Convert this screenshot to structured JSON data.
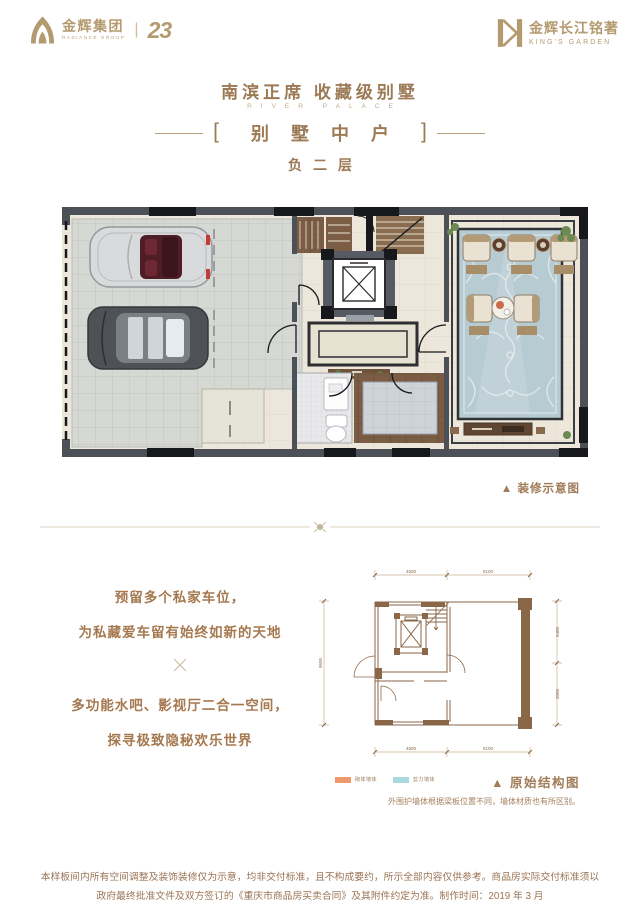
{
  "colors": {
    "accent_gold": "#B49A6F",
    "text_brown": "#9C7A56",
    "wall_dark": "#4C5158",
    "carpet_blue": "#B7CBD3",
    "legend_orange": "#F09A6B",
    "legend_blue": "#A9D9DF"
  },
  "header": {
    "brand_left": {
      "name": "金辉集团",
      "subtitle": "RADIANCE GROUP",
      "separator": "|",
      "anniversary": "23"
    },
    "brand_right": {
      "name": "金辉长江铭著",
      "subtitle": "KING'S GARDEN"
    }
  },
  "title": {
    "main": "南滨正席  收藏级别墅",
    "sub_en": "RIVER PALACE",
    "bracket_left": "[",
    "bracket_right": "]",
    "unit": "别墅中户",
    "floor": "负二层"
  },
  "floorplan": {
    "caption": "▲ 装修示意图"
  },
  "description": {
    "line1": "预留多个私家车位，",
    "line2": "为私藏爱车留有始终如新的天地",
    "line3": "多功能水吧、影视厅二合一空间，",
    "line4": "探寻极致隐秘欢乐世界"
  },
  "structure": {
    "caption": "▲ 原始结构图",
    "note": "外围护墙体根据梁板位置不同，墙体材质也有所区别。",
    "legend": [
      {
        "label": "砌体墙体",
        "color": "#F09A6B"
      },
      {
        "label": "剪力墙体",
        "color": "#A9D9DF"
      }
    ],
    "dims": {
      "top1": "4500",
      "top2": "5100",
      "bottom1": "4500",
      "bottom2": "5100",
      "left1": "9600",
      "right1": "5400",
      "right2": "3000"
    }
  },
  "disclaimer": {
    "line1": "本样板间内所有空间调整及装饰装修仅为示意，均非交付标准，且不构成要约，所示全部内容仅供参考。商品房实际交付标准须以",
    "line2": "政府最终批准文件及双方签订的《重庆市商品房买卖合同》及其附件约定为准。制作时间：2019 年 3 月"
  }
}
